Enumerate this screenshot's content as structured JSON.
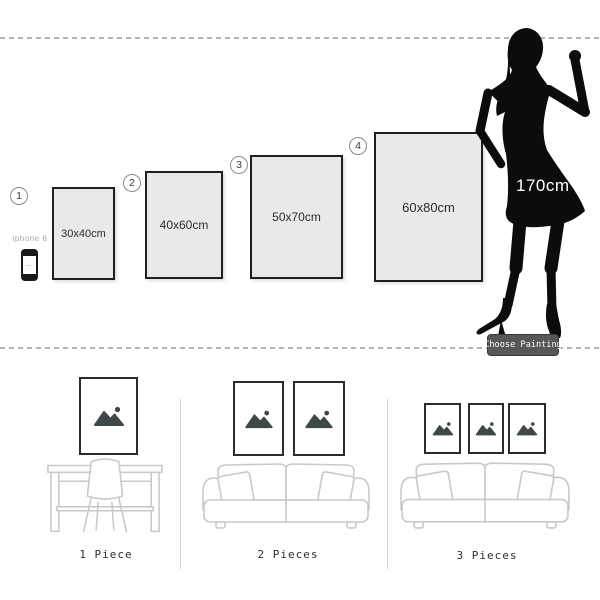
{
  "size_guide": {
    "frames": [
      {
        "number": "1",
        "label": "30x40cm"
      },
      {
        "number": "2",
        "label": "40x60cm"
      },
      {
        "number": "3",
        "label": "50x70cm"
      },
      {
        "number": "4",
        "label": "60x80cm"
      }
    ],
    "phone_label": "iphone 6",
    "model_height": "170cm",
    "choose_button": "Choose Painting"
  },
  "room_scenes": [
    {
      "label": "1 Piece",
      "frame_count": 1
    },
    {
      "label": "2 Pieces",
      "frame_count": 2
    },
    {
      "label": "3 Pieces",
      "frame_count": 3
    }
  ],
  "colors": {
    "frame_fill": "#e9e9e9",
    "frame_border": "#1f1f1f",
    "dash_line": "#b5b5b5",
    "furniture_outline": "#c9c9c9",
    "placeholder_icon": "#3e4849",
    "button_bg": "#575757",
    "text_dark": "#2e2e2e",
    "silhouette": "#0c0c0c"
  }
}
